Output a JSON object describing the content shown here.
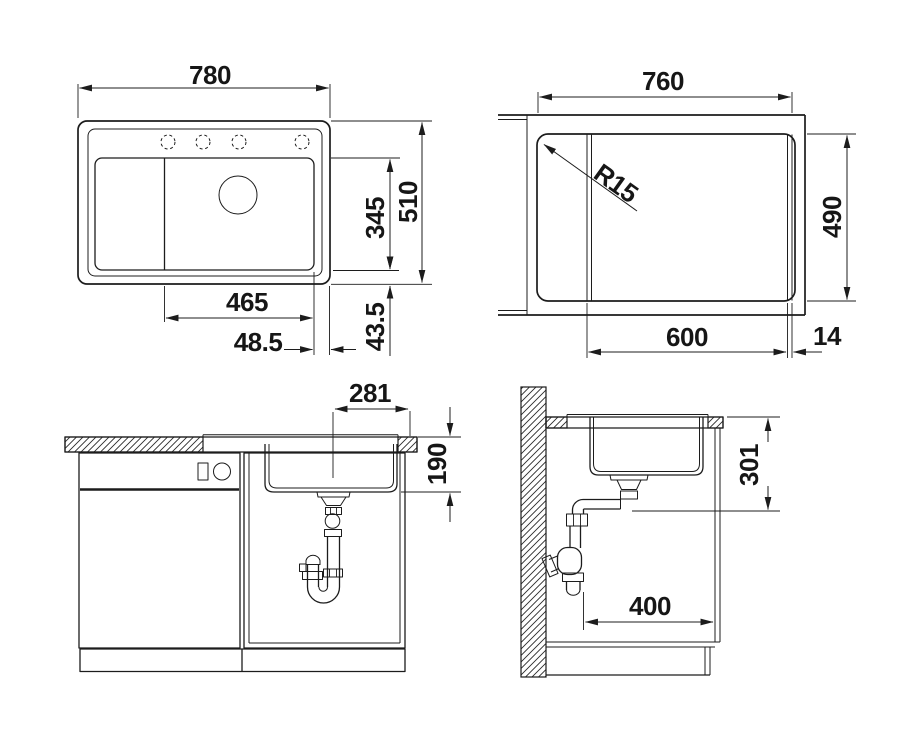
{
  "views": {
    "top": {
      "label": "sink top view",
      "dims": {
        "overall_width": "780",
        "overall_depth": "510",
        "bowl_depth": "345",
        "bowl_width": "465",
        "rim_right": "48.5",
        "rim_bottom": "43.5"
      }
    },
    "cutout": {
      "label": "worktop cutout view",
      "dims": {
        "cutout_width": "760",
        "corner_radius": "R15",
        "cutout_depth": "490",
        "cabinet_width": "600",
        "edge_offset": "14"
      }
    },
    "front": {
      "label": "front elevation with plumbing",
      "dims": {
        "drain_center_offset": "281",
        "bowl_inner_depth": "190"
      }
    },
    "side": {
      "label": "side section with plumbing",
      "dims": {
        "clearance_below_top": "301",
        "trap_depth": "400"
      }
    }
  },
  "colors": {
    "line": "#1c1c1c",
    "background": "#ffffff"
  }
}
